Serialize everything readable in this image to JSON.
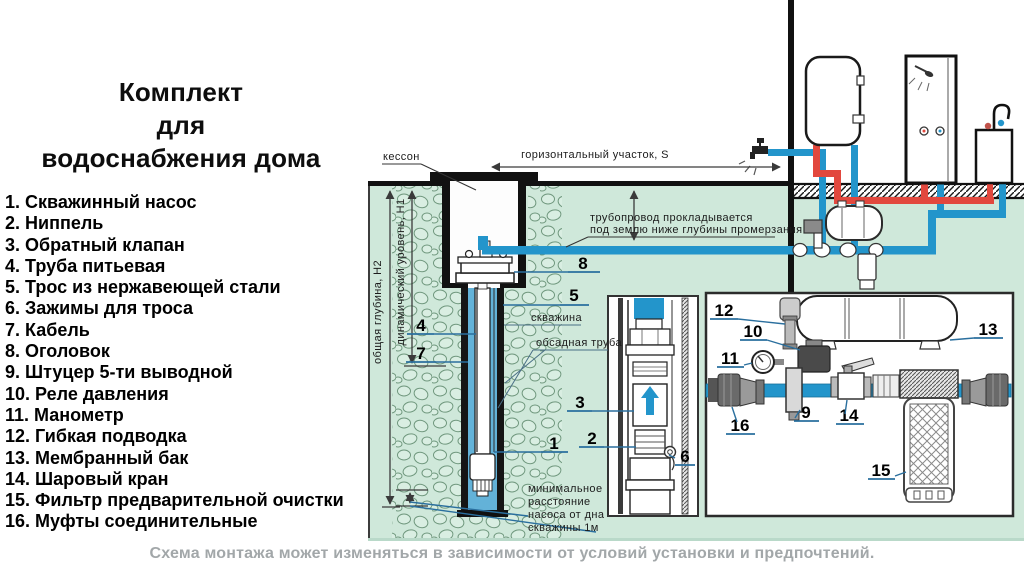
{
  "title": {
    "l1": "Комплект",
    "l2": "для",
    "l3": "водоснабжения дома"
  },
  "legend": {
    "items": [
      {
        "num": "1.",
        "label": "Скважинный насос"
      },
      {
        "num": "2.",
        "label": "Ниппель"
      },
      {
        "num": "3.",
        "label": "Обратный клапан"
      },
      {
        "num": "4.",
        "label": "Труба питьевая"
      },
      {
        "num": "5.",
        "label": "Трос из нержавеющей стали"
      },
      {
        "num": "6.",
        "label": "Зажимы для троса"
      },
      {
        "num": "7.",
        "label": "Кабель"
      },
      {
        "num": "8.",
        "label": "Оголовок"
      },
      {
        "num": "9.",
        "label": "Штуцер 5-ти выводной"
      },
      {
        "num": "10.",
        "label": "Реле давления"
      },
      {
        "num": "11.",
        "label": "Манометр"
      },
      {
        "num": "12.",
        "label": "Гибкая подводка"
      },
      {
        "num": "13.",
        "label": "Мембранный бак"
      },
      {
        "num": "14.",
        "label": "Шаровый кран"
      },
      {
        "num": "15.",
        "label": "Фильтр предварительной очистки"
      },
      {
        "num": "16.",
        "label": "Муфты соединительные"
      }
    ]
  },
  "diagram": {
    "labels": {
      "kesson": "кессон",
      "horizontal_section": "горизонтальный участок, S",
      "pipeline_note1": "трубопровод прокладывается",
      "pipeline_note2": "под землю ниже глубины промерзания",
      "total_depth": "общая глубина, Н2",
      "dynamic_level": "динамический уровень, Н1",
      "borehole": "скважина",
      "casing_pipe": "обсадная труба",
      "min_distance1": "минимальное",
      "min_distance2": "расстояние",
      "min_distance3": "насоса от дна",
      "min_distance4": "скважины 1м"
    },
    "callouts": {
      "c1": "1",
      "c2": "2",
      "c3": "3",
      "c4": "4",
      "c5": "5",
      "c6": "6",
      "c7": "7",
      "c8": "8",
      "c9": "9",
      "c10": "10",
      "c11": "11",
      "c12": "12",
      "c13": "13",
      "c14": "14",
      "c15": "15",
      "c16": "16"
    }
  },
  "footer": {
    "note": "Схема монтажа может изменяться в зависимости от условий установки и предпочтений."
  },
  "colors": {
    "pipe_cold_blue": "#2395cb",
    "pipe_hot_red": "#e2483e",
    "underground_green": "#cfe8da",
    "well_water_blue": "#63b2d8",
    "caption_gray": "#a2a7a9"
  }
}
